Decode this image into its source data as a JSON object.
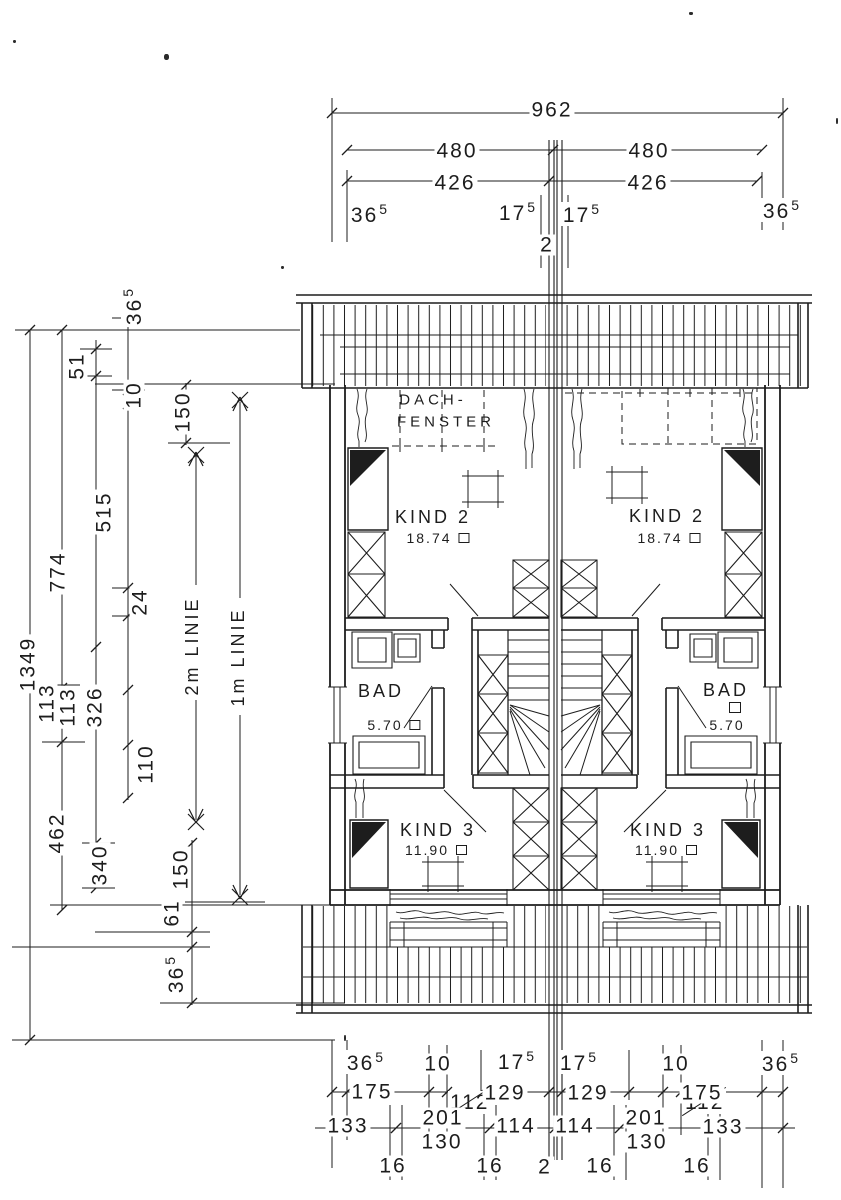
{
  "rooms": {
    "dachfenster": {
      "line1": "DACH-",
      "line2": "FENSTER"
    },
    "kind2_left": {
      "name": "KIND 2",
      "area": "18.74"
    },
    "kind2_right": {
      "name": "KIND 2",
      "area": "18.74"
    },
    "bad_left": {
      "name": "BAD",
      "area": "5.70"
    },
    "bad_right": {
      "name": "BAD",
      "area": "5.70"
    },
    "kind3_left": {
      "name": "KIND 3",
      "area": "11.90"
    },
    "kind3_right": {
      "name": "KIND 3",
      "area": "11.90"
    }
  },
  "dims_top": {
    "overall": "962",
    "l480": "480",
    "r480": "480",
    "l426": "426",
    "r426": "426",
    "l365": {
      "v": "36",
      "s": "5"
    },
    "l175": {
      "v": "17",
      "s": "5"
    },
    "r175": {
      "v": "17",
      "s": "5"
    },
    "r365": {
      "v": "36",
      "s": "5"
    },
    "gap": "2"
  },
  "dims_bottom": {
    "row1": {
      "l365": {
        "v": "36",
        "s": "5"
      },
      "l10": "10",
      "l175": {
        "v": "17",
        "s": "5"
      },
      "r175": {
        "v": "17",
        "s": "5"
      },
      "r10": "10",
      "r365": {
        "v": "36",
        "s": "5"
      }
    },
    "row2": {
      "l175": "175",
      "l112": "112",
      "l129": "129",
      "r129": "129",
      "r112": "112",
      "r175": "175"
    },
    "row3": {
      "l133": "133",
      "l201": "201",
      "l130": "130",
      "l114": "114",
      "r114": "114",
      "r201": "201",
      "r130": "130",
      "r133": "133"
    },
    "row4": {
      "a": "16",
      "b": "16",
      "c": "2",
      "d": "16",
      "e": "16"
    }
  },
  "dims_left": {
    "overall": "1349",
    "d774": "774",
    "d462": "462",
    "d51": "51",
    "d515": "515",
    "d113a": "113",
    "d113b": "113",
    "d326": "326",
    "d110": "110",
    "d340": "340",
    "t365": {
      "v": "36",
      "s": "5"
    },
    "d10": "10",
    "d24": "24",
    "d150a": "150",
    "d150b": "150",
    "d61": "61",
    "b365": {
      "v": "36",
      "s": "5"
    }
  },
  "ref_lines": {
    "two_m": "2m LINIE",
    "one_m": "1m LINIE"
  },
  "icons": {
    "area_unit": "square-meter-box"
  },
  "ink_color": "#1d1d1d"
}
